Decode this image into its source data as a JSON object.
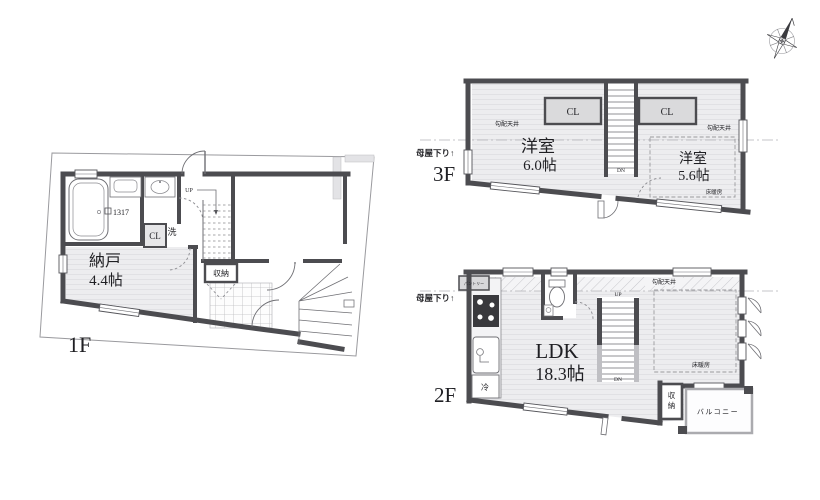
{
  "plan": {
    "type": "floor-plan",
    "colors": {
      "wall": "#4c4c50",
      "room_fill": "#ededef",
      "closet_fill": "#dadadc",
      "thin_line": "#6f6f74",
      "text": "#1f1f23",
      "background": "#ffffff"
    }
  },
  "f1": {
    "label": "1F",
    "up": "UP",
    "storage": "収納",
    "closet": "CL",
    "laundry": "洗",
    "room": "納戸",
    "area": "4.4帖",
    "bath": "1317"
  },
  "f2": {
    "label": "2F",
    "dormer": "母屋下り↑",
    "pantry": "パントリー",
    "sloped": "勾配天井",
    "up": "UP",
    "down": "DN",
    "room": "LDK",
    "area": "18.3帖",
    "heating": "床暖房",
    "fridge": "冷",
    "storage_a": "収",
    "storage_b": "納",
    "balcony": "バルコニー"
  },
  "f3": {
    "label": "3F",
    "dormer": "母屋下り↑",
    "sloped_l": "勾配天井",
    "sloped_r": "勾配天井",
    "cl_l": "CL",
    "cl_r": "CL",
    "room_l": "洋室",
    "area_l": "6.0帖",
    "room_r": "洋室",
    "area_r": "5.6帖",
    "heating": "床暖房",
    "down": "DN"
  }
}
